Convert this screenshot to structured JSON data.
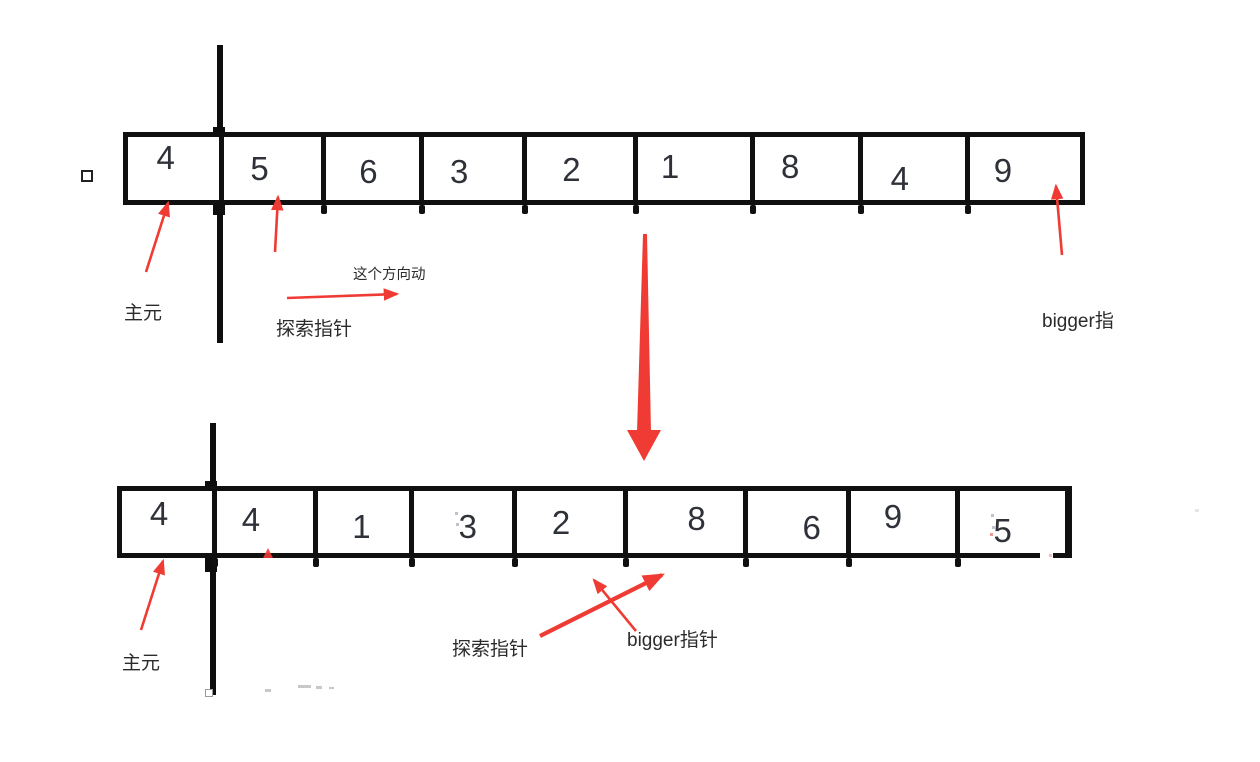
{
  "colors": {
    "red": "#ef3b33",
    "ink": "#101010",
    "digit": "#2e3238",
    "label": "#2b2b2b"
  },
  "top_section": {
    "array_values": [
      "4",
      "5",
      "6",
      "3",
      "2",
      "1",
      "8",
      "4",
      "9"
    ],
    "pivot_label": "主元",
    "probe_label": "探索指针",
    "direction_label": "这个方向动",
    "bigger_label": "bigger指"
  },
  "bottom_section": {
    "array_values": [
      "4",
      "4",
      "1",
      "3",
      "2",
      "8",
      "6",
      "9",
      "5"
    ],
    "pivot_label": "主元",
    "probe_label": "探索指针",
    "bigger_label": "bigger指针"
  }
}
